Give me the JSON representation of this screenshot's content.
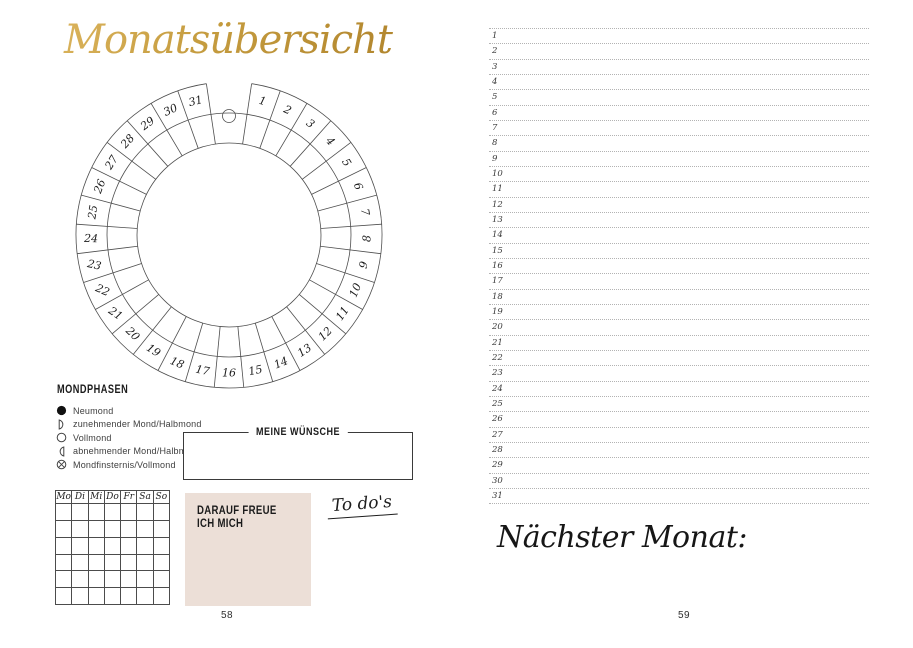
{
  "accent_colors": {
    "gold": "#c59c3f",
    "box_beige": "#ecdfd7",
    "line_gray": "#b3b3b3"
  },
  "left_page": {
    "title": "Monatsübersicht",
    "wheel": {
      "days": [
        1,
        2,
        3,
        4,
        5,
        6,
        7,
        8,
        9,
        10,
        11,
        12,
        13,
        14,
        15,
        16,
        17,
        18,
        19,
        20,
        21,
        22,
        23,
        24,
        25,
        26,
        27,
        28,
        29,
        30,
        31
      ]
    },
    "mondphasen": {
      "heading": "MONDPHASEN",
      "items": [
        {
          "icon": "new-moon-icon",
          "label": "Neumond"
        },
        {
          "icon": "waxing-half-moon-icon",
          "label": "zunehmender Mond/Halbmond"
        },
        {
          "icon": "full-moon-icon",
          "label": "Vollmond"
        },
        {
          "icon": "waning-half-moon-icon",
          "label": "abnehmender Mond/Halbmond"
        },
        {
          "icon": "lunar-eclipse-icon",
          "label": "Mondfinsternis/Vollmond"
        }
      ]
    },
    "wishes_box": {
      "title": "MEINE WÜNSCHE"
    },
    "week_table": {
      "headers": [
        "Mo",
        "Di",
        "Mi",
        "Do",
        "Fr",
        "Sa",
        "So"
      ],
      "empty_rows": 6
    },
    "looking_forward_box": {
      "text": "DARAUF FREUE\nICH MICH"
    },
    "todos_label": "To do's",
    "page_number": "58"
  },
  "right_page": {
    "line_numbers": [
      "1",
      "2",
      "3",
      "4",
      "5",
      "6",
      "7",
      "8",
      "9",
      "10",
      "11",
      "12",
      "13",
      "14",
      "15",
      "16",
      "17",
      "18",
      "19",
      "20",
      "21",
      "22",
      "23",
      "24",
      "25",
      "26",
      "27",
      "28",
      "29",
      "30",
      "31"
    ],
    "next_month_label": "Nächster Monat:",
    "page_number": "59"
  }
}
